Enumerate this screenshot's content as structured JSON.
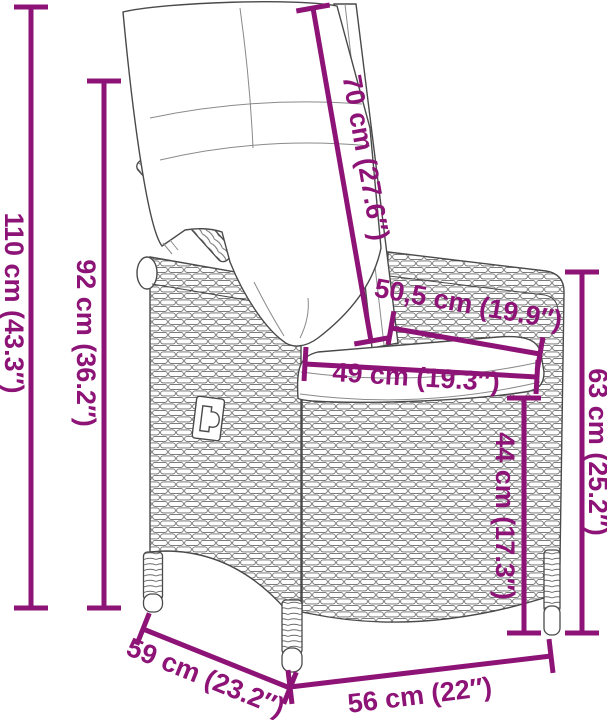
{
  "page": {
    "type": "product-dimensions-diagram",
    "subject": "poly rattan reclining garden chair with cushions",
    "background": "#ffffff"
  },
  "style": {
    "dimension_color": "#8D1476",
    "outline_color": "#4a4a4a"
  },
  "dimensions": [
    {
      "name": "total-height",
      "label": "110 cm (43.3″)",
      "cm": 110,
      "inches": 43.3,
      "orientation": "vertical"
    },
    {
      "name": "backrest-height",
      "label": "92 cm (36.2″)",
      "cm": 92,
      "inches": 36.2,
      "orientation": "vertical"
    },
    {
      "name": "backrest-length",
      "label": "70 cm (27.6″)",
      "cm": 70,
      "inches": 27.6,
      "orientation": "diagonal-along-backrest"
    },
    {
      "name": "seat-depth",
      "label": "50,5 cm (19.9″)",
      "cm": 50.5,
      "inches": 19.9,
      "orientation": "diagonal-along-seat"
    },
    {
      "name": "seat-width",
      "label": "49 cm (19.3″)",
      "cm": 49,
      "inches": 19.3,
      "orientation": "horizontal"
    },
    {
      "name": "armrest-height",
      "label": "63 cm (25.2″)",
      "cm": 63,
      "inches": 25.2,
      "orientation": "vertical"
    },
    {
      "name": "seat-height",
      "label": "44 cm (17.3″)",
      "cm": 44,
      "inches": 17.3,
      "orientation": "vertical"
    },
    {
      "name": "overall-depth",
      "label": "59 cm (23.2″)",
      "cm": 59,
      "inches": 23.2,
      "orientation": "diagonal-ground"
    },
    {
      "name": "overall-width",
      "label": "56 cm (22″)",
      "cm": 56,
      "inches": 22,
      "orientation": "horizontal-ground"
    }
  ]
}
